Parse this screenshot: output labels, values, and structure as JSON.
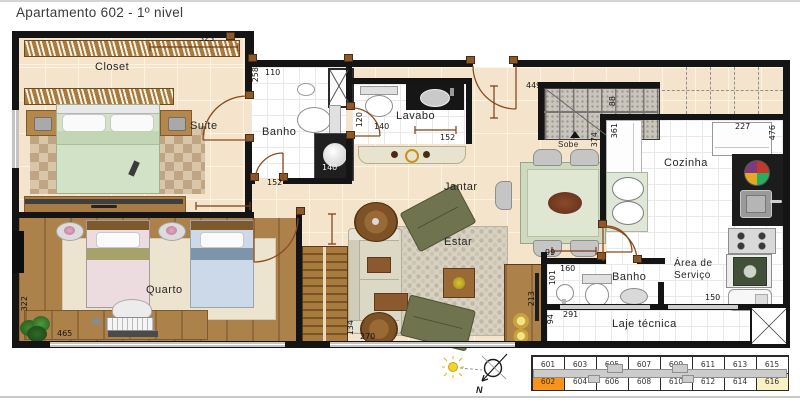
{
  "title": "Apartamento 602 - 1º nivel",
  "rooms": {
    "closet": "Closet",
    "suite": "Suite",
    "banho1": "Banho",
    "lavabo": "Lavabo",
    "jantar": "Jantar",
    "estar": "Estar",
    "quarto": "Quarto",
    "cozinha": "Cozinha",
    "sobe": "Sobe",
    "banho2": "Banho",
    "area_servico": "Área de\nServiço",
    "laje": "Laje técnica"
  },
  "dimensions": [
    {
      "t": "323",
      "x": 199,
      "y": 35
    },
    {
      "t": "110",
      "x": 265,
      "y": 69
    },
    {
      "t": "258",
      "x": 252,
      "y": 67,
      "v": true
    },
    {
      "t": "140",
      "x": 322,
      "y": 164,
      "light": true
    },
    {
      "t": "152",
      "x": 267,
      "y": 179
    },
    {
      "t": "95",
      "x": 245,
      "y": 184,
      "v": true
    },
    {
      "t": "120",
      "x": 356,
      "y": 112,
      "v": true
    },
    {
      "t": "140",
      "x": 374,
      "y": 123
    },
    {
      "t": "152",
      "x": 440,
      "y": 134
    },
    {
      "t": "101",
      "x": 347,
      "y": 146,
      "v": true
    },
    {
      "t": "449",
      "x": 526,
      "y": 82
    },
    {
      "t": "88",
      "x": 609,
      "y": 96,
      "v": true
    },
    {
      "t": "374",
      "x": 591,
      "y": 132,
      "v": true
    },
    {
      "t": "361",
      "x": 611,
      "y": 123,
      "v": true
    },
    {
      "t": "227",
      "x": 735,
      "y": 123
    },
    {
      "t": "476",
      "x": 769,
      "y": 125,
      "v": true
    },
    {
      "t": "99",
      "x": 545,
      "y": 249
    },
    {
      "t": "160",
      "x": 560,
      "y": 265
    },
    {
      "t": "101",
      "x": 549,
      "y": 270,
      "v": true
    },
    {
      "t": "150",
      "x": 705,
      "y": 294
    },
    {
      "t": "291",
      "x": 563,
      "y": 311
    },
    {
      "t": "94",
      "x": 547,
      "y": 314,
      "v": true
    },
    {
      "t": "213",
      "x": 528,
      "y": 291,
      "v": true
    },
    {
      "t": "134",
      "x": 347,
      "y": 320,
      "v": true
    },
    {
      "t": "270",
      "x": 360,
      "y": 333
    },
    {
      "t": "465",
      "x": 57,
      "y": 330
    },
    {
      "t": "322",
      "x": 21,
      "y": 296,
      "v": true
    }
  ],
  "keyplan": {
    "top_row": [
      "601",
      "603",
      "605",
      "607",
      "609",
      "611",
      "613",
      "615"
    ],
    "bottom_row": [
      "602",
      "604",
      "606",
      "608",
      "610",
      "612",
      "614",
      "616"
    ],
    "highlight_unit": "602",
    "secondary_unit": "616"
  },
  "compass": {
    "north_label": "N"
  },
  "colors": {
    "highlight": "#F7941E",
    "highlight_text": "#4a2a00",
    "secondary": "#F6F2C2",
    "wall": "#141414",
    "floor_beige": "#f4e4cb",
    "wood": "#a87a3e",
    "dim_line": "#7a3e16"
  }
}
